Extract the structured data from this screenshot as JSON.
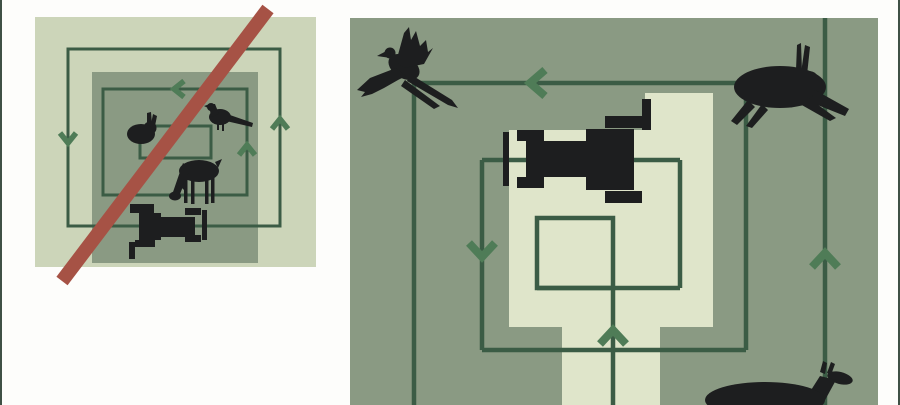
{
  "page": {
    "background": "#fdfdfb",
    "side_border_color": "#3f5045"
  },
  "palette": {
    "page_bg": "#fdfdfb",
    "side_border": "#3f5045",
    "field_light": "#ccd5b9",
    "field_dark": "#8a9a83",
    "mown_light": "#dfe5ca",
    "line_green": "#3b5c45",
    "arrow_green": "#4f7c57",
    "prohibition_red": "#a65245",
    "silhouette": "#1d1e1f"
  },
  "panels": {
    "left": {
      "id": "mowing-inward-spiral-crossed-out",
      "crossed_out": true,
      "icons": [
        "field",
        "unmown-center-square",
        "concentric-mowing-path",
        "tractor-top-view",
        "rabbit-icon",
        "pheasant-icon",
        "grazing-deer-icon",
        "prohibition-slash-icon"
      ],
      "arrows": [
        {
          "direction": "down",
          "position": "outer-left"
        },
        {
          "direction": "up",
          "position": "outer-right"
        },
        {
          "direction": "left",
          "position": "middle-top"
        },
        {
          "direction": "up",
          "position": "middle-right"
        }
      ]
    },
    "right": {
      "id": "mowing-from-center-outward",
      "crossed_out": false,
      "icons": [
        "field",
        "mown-center-area",
        "concentric-mowing-path",
        "tractor-top-view",
        "flying-pheasant-icon",
        "leaping-hare-icon",
        "fleeing-deer-icon"
      ],
      "arrows": [
        {
          "direction": "left",
          "position": "outer-top"
        },
        {
          "direction": "down",
          "position": "middle-left"
        },
        {
          "direction": "up",
          "position": "center-exit"
        },
        {
          "direction": "up",
          "position": "outer-right"
        }
      ]
    }
  }
}
